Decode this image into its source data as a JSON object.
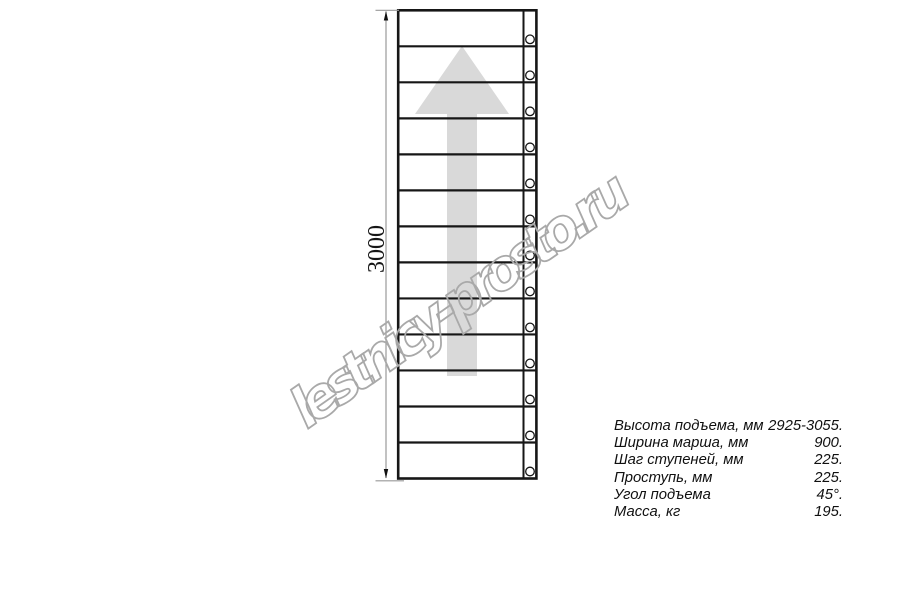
{
  "drawing": {
    "dimension_label": "3000",
    "steps_count": 13,
    "colors": {
      "line": "#161616",
      "arrow": "#d9d9d9",
      "watermark": "#a9a9a9",
      "dim": "#999999"
    }
  },
  "watermark": {
    "text": "lestnicy-prosto.ru"
  },
  "specs": {
    "rows": [
      {
        "label": "Высота подъема, мм",
        "value": "2925-3055."
      },
      {
        "label": "Ширина марша, мм",
        "value": "900."
      },
      {
        "label": "Шаг ступеней, мм",
        "value": "225."
      },
      {
        "label": "Проступь, мм",
        "value": "225."
      },
      {
        "label": "Угол подъема",
        "value": "45°."
      },
      {
        "label": "Масса, кг",
        "value": "195."
      }
    ]
  }
}
